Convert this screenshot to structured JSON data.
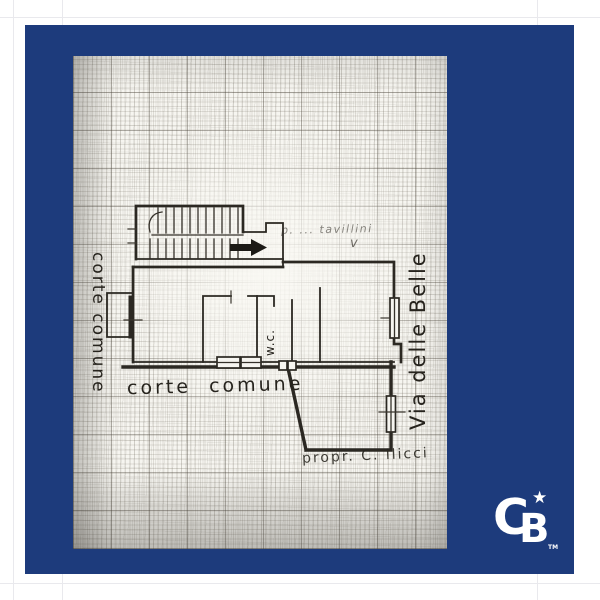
{
  "page": {
    "background": "#ffffff",
    "frame_color": "#1d3b7c",
    "margin_line_color": "#e9e9ed",
    "paper_color": "#f6f5f0",
    "ink_color": "#2b2822"
  },
  "logo": {
    "name": "Coldwell Banker",
    "c": "C",
    "b": "B",
    "star": "★",
    "tm": "TM"
  },
  "floorplan": {
    "labels": {
      "courtyard_left": "corte comune",
      "courtyard_bottom": "corte comune",
      "wc": "w.c.",
      "street": "Via delle Belle",
      "handwritten_top": "p. ... tavillini",
      "handwritten_mark": "v",
      "owner_bottom": "propr. C. ilicci"
    }
  }
}
